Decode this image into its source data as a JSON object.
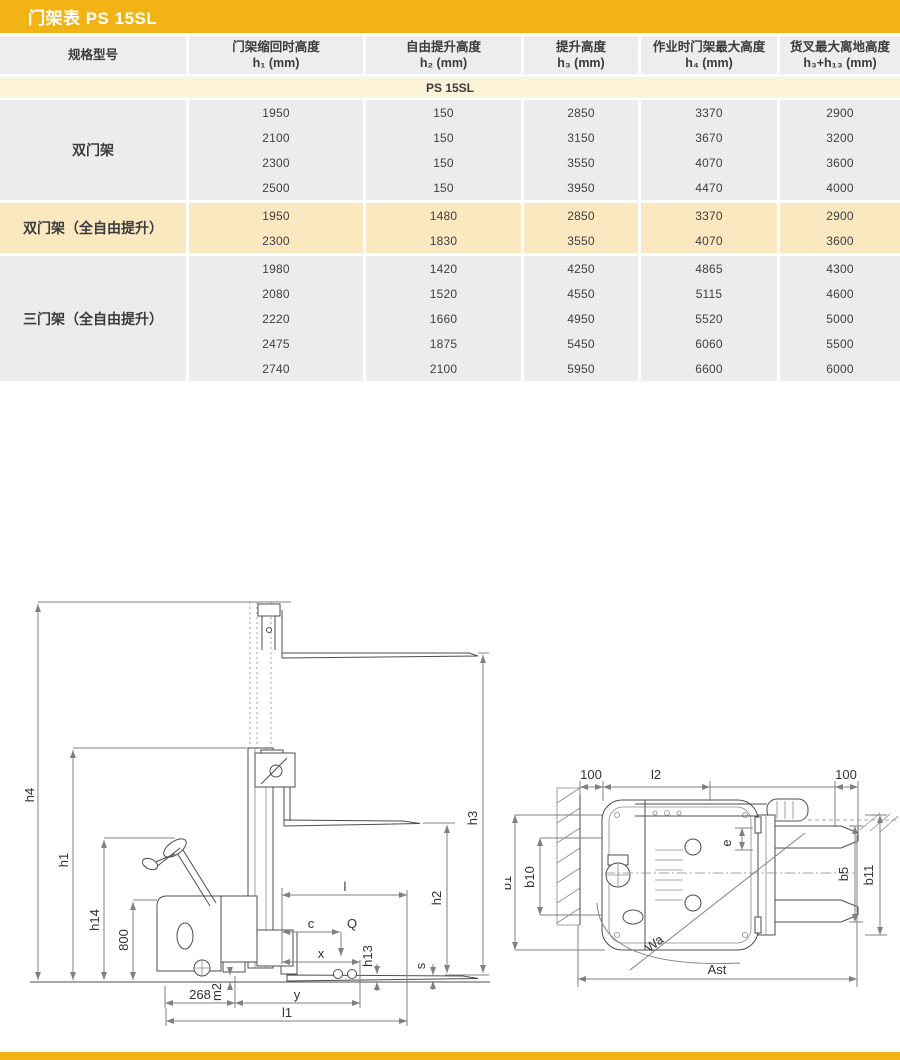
{
  "page": {
    "title": "门架表 PS 15SL"
  },
  "colors": {
    "gold": "#F2B415",
    "cream_row": "#FCF3D8",
    "cream_section": "#FAE9C0",
    "gray_cell": "#ECECEC"
  },
  "table": {
    "headers": [
      {
        "line1": "规格型号",
        "line2": ""
      },
      {
        "line1": "门架缩回时高度",
        "line2": "h₁ (mm)"
      },
      {
        "line1": "自由提升高度",
        "line2": "h₂ (mm)"
      },
      {
        "line1": "提升高度",
        "line2": "h₃ (mm)"
      },
      {
        "line1": "作业时门架最大高度",
        "line2": "h₄ (mm)"
      },
      {
        "line1": "货叉最大离地高度",
        "line2": "h₃+h₁₃ (mm)"
      }
    ],
    "subheader": "PS 15SL",
    "sections": [
      {
        "label": "双门架",
        "tone": "gray",
        "rows": [
          [
            "1950",
            "150",
            "2850",
            "3370",
            "2900"
          ],
          [
            "2100",
            "150",
            "3150",
            "3670",
            "3200"
          ],
          [
            "2300",
            "150",
            "3550",
            "4070",
            "3600"
          ],
          [
            "2500",
            "150",
            "3950",
            "4470",
            "4000"
          ]
        ]
      },
      {
        "label": "双门架（全自由提升）",
        "tone": "cream",
        "rows": [
          [
            "1950",
            "1480",
            "2850",
            "3370",
            "2900"
          ],
          [
            "2300",
            "1830",
            "3550",
            "4070",
            "3600"
          ]
        ]
      },
      {
        "label": "三门架（全自由提升）",
        "tone": "gray",
        "rows": [
          [
            "1980",
            "1420",
            "4250",
            "4865",
            "4300"
          ],
          [
            "2080",
            "1520",
            "4550",
            "5115",
            "4600"
          ],
          [
            "2220",
            "1660",
            "4950",
            "5520",
            "5000"
          ],
          [
            "2475",
            "1875",
            "5450",
            "6060",
            "5500"
          ],
          [
            "2740",
            "2100",
            "5950",
            "6600",
            "6000"
          ]
        ]
      }
    ]
  },
  "diagram": {
    "side": {
      "h4": "h4",
      "h1": "h1",
      "h14": "h14",
      "height_800": "800",
      "h3": "h3",
      "h2": "h2",
      "h13": "h13",
      "s": "s",
      "l": "l",
      "c": "c",
      "q": "Q",
      "x": "x",
      "dim_268": "268",
      "m2": "m2",
      "y": "y",
      "l1": "l1"
    },
    "top": {
      "left_100": "100",
      "l2": "l2",
      "right_100": "100",
      "b1": "b1",
      "b10": "b10",
      "e": "e",
      "b5": "b5",
      "b11": "b11",
      "wa": "Wa",
      "ast": "Ast"
    }
  }
}
